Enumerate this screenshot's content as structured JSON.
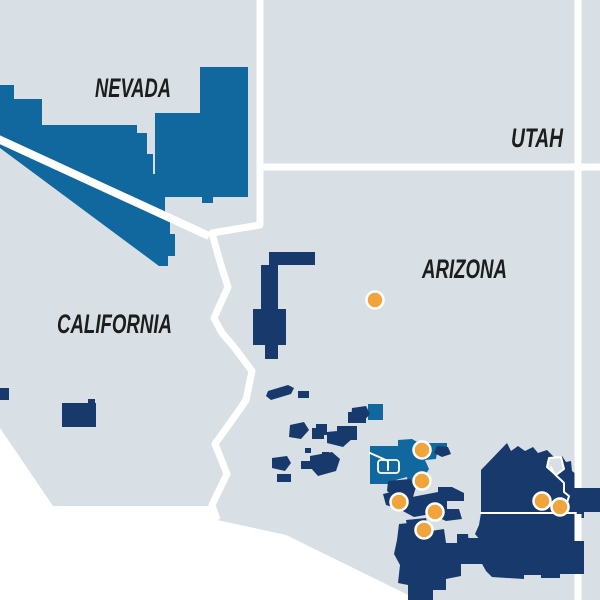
{
  "map": {
    "region_name": "Southwestern United States map",
    "colors": {
      "background": "#ffffff",
      "state_fill": "#d8e0e6",
      "state_border": "#ffffff",
      "parcel_medium_blue": "#11689e",
      "parcel_navy": "#17396b",
      "marker_fill": "#f2a43c",
      "marker_ring": "#ffffff",
      "label_color": "#1d1d1b"
    },
    "state_labels": [
      {
        "id": "nevada",
        "text": "NEVADA",
        "x": 95,
        "baseline": 97,
        "length": 76
      },
      {
        "id": "utah",
        "text": "UTAH",
        "x": 511,
        "baseline": 147,
        "length": 52
      },
      {
        "id": "california",
        "text": "CALIFORNIA",
        "x": 57,
        "baseline": 333,
        "length": 115
      },
      {
        "id": "arizona",
        "text": "ARIZONA",
        "x": 422,
        "baseline": 278,
        "length": 85
      }
    ],
    "markers": {
      "radius": 8.5,
      "points": [
        {
          "x": 375,
          "y": 300
        },
        {
          "x": 422,
          "y": 450
        },
        {
          "x": 422,
          "y": 481
        },
        {
          "x": 399,
          "y": 502
        },
        {
          "x": 435,
          "y": 512
        },
        {
          "x": 424,
          "y": 530
        },
        {
          "x": 542,
          "y": 501
        },
        {
          "x": 560,
          "y": 507
        }
      ]
    }
  }
}
